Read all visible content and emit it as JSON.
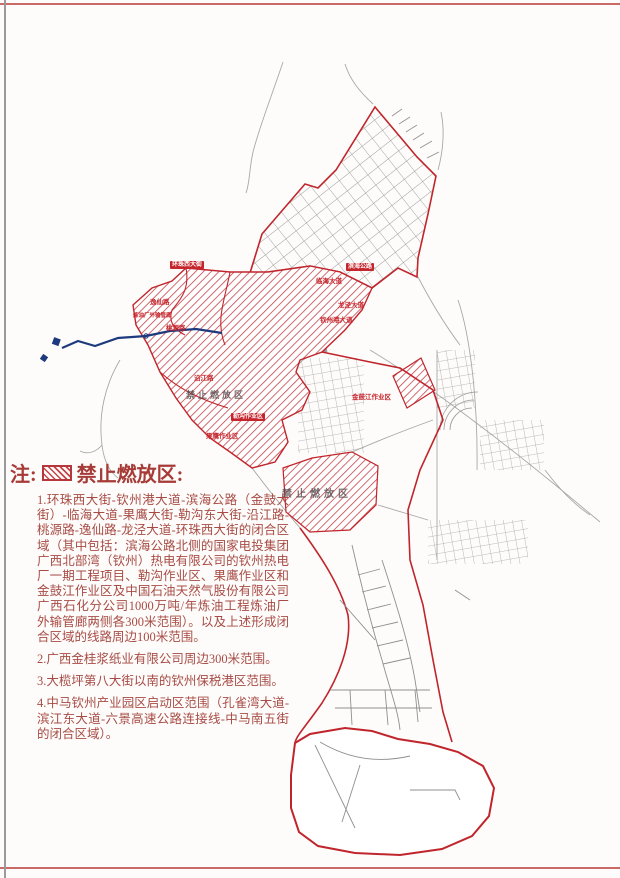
{
  "note": {
    "prefix": "注:",
    "heading": "禁止燃放区:",
    "items": [
      "1.环珠西大街-钦州港大道-滨海公路（金鼓大街）-临海大道-果鹰大街-勒沟东大街-沿江路-桃源路-逸仙路-龙泾大道-环珠西大街的闭合区域（其中包括：滨海公路北侧的国家电投集团广西北部湾（钦州）热电有限公司的钦州热电厂一期工程项目、勒沟作业区、果鹰作业区和金鼓江作业区及中国石油天然气股份有限公司广西石化分公司1000万吨/年炼油工程炼油厂外输管廊两侧各300米范围）。以及上述形成闭合区域的线路周边100米范围。",
      "2.广西金桂浆纸业有限公司周边300米范围。",
      "3.大榄坪第八大街以南的钦州保税港区范围。",
      "4.中马钦州产业园区启动区范围（孔雀湾大道-滨江东大道-六景高速公路连接线-中马南五街的闭合区域）。"
    ]
  },
  "map": {
    "labels": [
      {
        "text": "环珠西大街"
      },
      {
        "text": "滨海公路"
      },
      {
        "text": "勒沟作业区"
      },
      {
        "text": "逸仙路"
      },
      {
        "text": "桃源路"
      },
      {
        "text": "沿江路"
      },
      {
        "text": "果鹰作业区"
      },
      {
        "text": "临海大道"
      },
      {
        "text": "龙泾大道"
      },
      {
        "text": "钦州港大道"
      },
      {
        "text": "金鼓江作业区"
      },
      {
        "text": "炼油厂外输管廊"
      },
      {
        "text": "禁止燃放区"
      },
      {
        "text": "禁止燃放区"
      }
    ],
    "colors": {
      "boundary_red": "#c0252c",
      "hatch_red": "#c43a3f",
      "note_text": "#a84b45",
      "pipeline_blue": "#1e3a7e",
      "road_gray": "#8f8f8f"
    }
  }
}
